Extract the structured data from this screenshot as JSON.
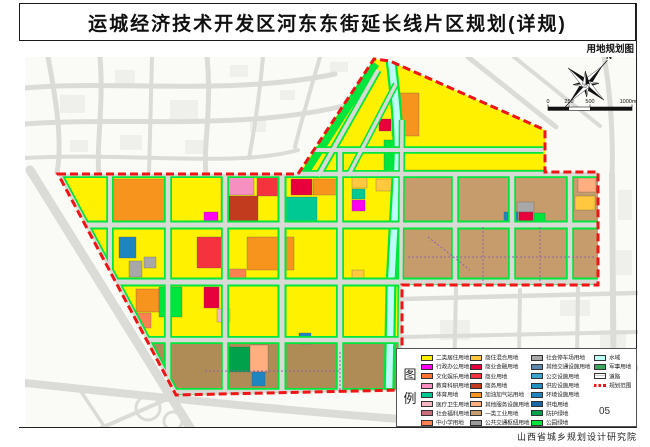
{
  "page": {
    "title": "运城经济技术开发区河东东街延长线片区规划(详规)",
    "map_type_label": "用地规划图",
    "sheet_number": "05",
    "institute": "山西省城乡规划设计研究院"
  },
  "compass": {
    "north_label": "N"
  },
  "scale_bar": {
    "labels": [
      "0",
      "250",
      "500",
      "1000m"
    ]
  },
  "legend": {
    "title": "图例",
    "columns": [
      {
        "items": [
          {
            "label": "二类居住用地",
            "color": "#FFF100"
          },
          {
            "label": "行政办公用地",
            "color": "#FF00F0"
          },
          {
            "label": "文化娱乐用地",
            "color": "#FF7430"
          },
          {
            "label": "教育科研用地",
            "color": "#F590C0"
          },
          {
            "label": "体育用地",
            "color": "#00C993"
          },
          {
            "label": "医疗卫生用地",
            "color": "#F5B8C0"
          },
          {
            "label": "社会福利用地",
            "color": "#C96D7C"
          },
          {
            "label": "中小学用地",
            "color": "#FF8050"
          }
        ]
      },
      {
        "items": [
          {
            "label": "商住混合用地",
            "color": "#FFC83E"
          },
          {
            "label": "商业金融用地",
            "color": "#E8003D"
          },
          {
            "label": "商业用地",
            "color": "#F5333F"
          },
          {
            "label": "商务用地",
            "color": "#C23B1E"
          },
          {
            "label": "加油加气站用地",
            "color": "#F7941E"
          },
          {
            "label": "其他服务设施用地",
            "color": "#FFAE80"
          },
          {
            "label": "一类工业用地",
            "color": "#C69C6D"
          },
          {
            "label": "公共交通枢纽用地",
            "color": "#9C9C9C"
          }
        ]
      },
      {
        "items": [
          {
            "label": "社会停车场用地",
            "color": "#A8A8A8"
          },
          {
            "label": "其他交通设施用地",
            "color": "#5E87AD"
          },
          {
            "label": "公交设施用地",
            "color": "#3AA6D0"
          },
          {
            "label": "供应设施用地",
            "color": "#2090C0"
          },
          {
            "label": "环境设施用地",
            "color": "#1F85C0"
          },
          {
            "label": "供电用地",
            "color": "#1668A8"
          },
          {
            "label": "防护绿地",
            "color": "#00A14B"
          },
          {
            "label": "公园绿地",
            "color": "#00E63C"
          }
        ]
      },
      {
        "items": [
          {
            "label": "水域",
            "color": "#BCFDF7"
          },
          {
            "label": "军事用地",
            "color": "#3BA55D"
          },
          {
            "label": "道路",
            "type": "road"
          },
          {
            "label": "规划范围",
            "color": "#F01414",
            "type": "dashed"
          }
        ]
      }
    ]
  },
  "map": {
    "boundary_color": "#F01414",
    "palette": {
      "yellow": "#FFF100",
      "gold": "#FFC83E",
      "orange": "#F7941E",
      "magenta": "#FF00F0",
      "pink": "#F590C0",
      "palepink": "#F5B8C0",
      "rose": "#C96D7C",
      "coral": "#FF8050",
      "salmon": "#FFAE80",
      "red": "#F5333F",
      "crimson": "#E8003D",
      "brickred": "#C23B1E",
      "tan": "#C69C6D",
      "darktan": "#AF8C55",
      "green": "#00E63C",
      "darkgreen": "#00A14B",
      "teal": "#00C993",
      "cyan": "#BCFDF7",
      "blue": "#1F85C0",
      "slate": "#5E87AD",
      "gray": "#A8A8A8",
      "roadgray": "#D9D9D5",
      "fabric": "#DBDBD7"
    }
  }
}
